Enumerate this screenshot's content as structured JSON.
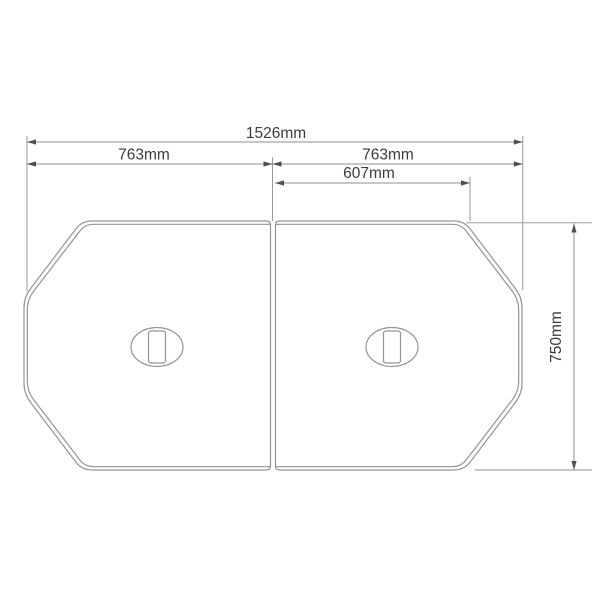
{
  "diagram": {
    "type": "technical-drawing",
    "dimensions": {
      "total_width": {
        "label": "1526mm",
        "value_mm": 1526
      },
      "left_panel_width": {
        "label": "763mm",
        "value_mm": 763
      },
      "right_panel_width": {
        "label": "763mm",
        "value_mm": 763
      },
      "inner_width": {
        "label": "607mm",
        "value_mm": 607
      },
      "depth": {
        "label": "750mm",
        "value_mm": 750
      }
    },
    "colors": {
      "outline": "#949494",
      "dimension_line": "#8f8f8f",
      "arrow": "#4f4f4f",
      "label_text": "#3b3b3b",
      "background": "#ffffff"
    }
  }
}
